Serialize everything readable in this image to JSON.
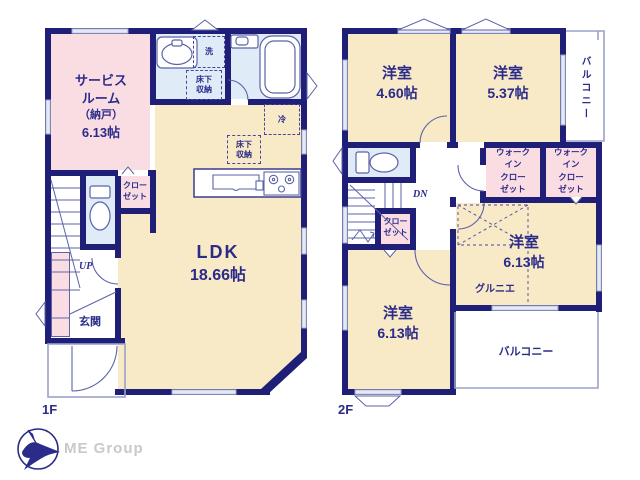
{
  "branding": {
    "company": "ME Group"
  },
  "floor1": {
    "floor_label": "1F",
    "service_room": {
      "line1": "サービス",
      "line2": "ルーム",
      "line3": "（納戸）",
      "size": "6.13帖"
    },
    "ldk": {
      "name": "LDK",
      "size": "18.66帖"
    },
    "entrance": "玄関",
    "stairs_up": "UP",
    "closet": {
      "line1": "クロー",
      "line2": "ゼット"
    },
    "laundry": "洗",
    "underfloor_storage_1": {
      "line1": "床下",
      "line2": "収納"
    },
    "underfloor_storage_2": {
      "line1": "床下",
      "line2": "収納"
    },
    "refrigerator": "冷"
  },
  "floor2": {
    "floor_label": "2F",
    "room_a": {
      "name": "洋室",
      "size": "4.60帖"
    },
    "room_b": {
      "name": "洋室",
      "size": "5.37帖"
    },
    "balcony_east": "バルコニー",
    "wic_1": {
      "line1": "ウォーク",
      "line2": "イン",
      "line3": "クロー",
      "line4": "ゼット"
    },
    "wic_2": {
      "line1": "ウォーク",
      "line2": "イン",
      "line3": "クロー",
      "line4": "ゼット"
    },
    "stairs_down": "DN",
    "closet": {
      "line1": "クロー",
      "line2": "ゼット"
    },
    "room_c": {
      "name": "洋室",
      "size": "6.13帖",
      "note": "グルニエ"
    },
    "room_d": {
      "name": "洋室",
      "size": "6.13帖"
    },
    "balcony_south": "バルコニー"
  },
  "colors": {
    "wall": "#1f1f78",
    "room_beige": "#f8e9c7",
    "room_pink": "#fadde2",
    "room_blue": "#dfebf6",
    "text": "#2b2b8a"
  }
}
